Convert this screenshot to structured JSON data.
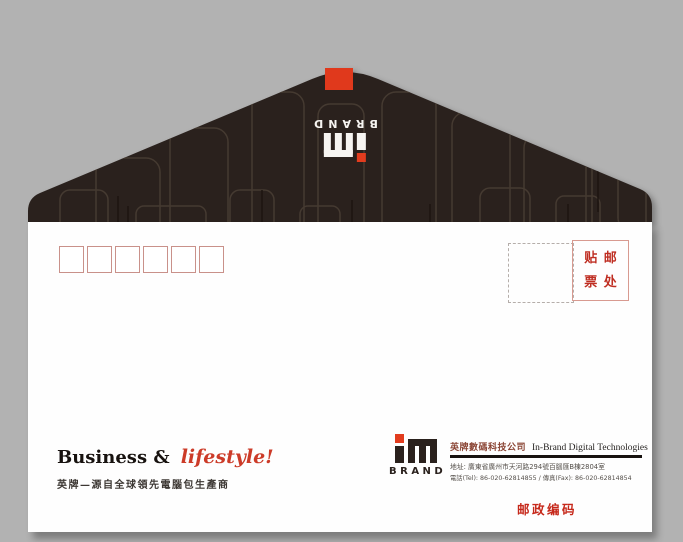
{
  "colors": {
    "background": "#b2b2b2",
    "flap": "#2a211d",
    "accent_red": "#e23c1e",
    "stamp_text_red": "#bf2e22",
    "postal_label_red": "#c6281a",
    "envelope": "#fefefe"
  },
  "logo": {
    "brand": "BRAND",
    "mark": "in-monogram"
  },
  "postal_code_boxes": {
    "count": 6
  },
  "stamp_area": {
    "top_left": "贴",
    "top_right": "邮",
    "bottom_left": "票",
    "bottom_right": "处"
  },
  "footer": {
    "tagline_en_black": "Business &",
    "tagline_en_red": "lifestyle!",
    "tagline_cn": "英牌—源自全球領先電腦包生產商",
    "postal_code_label": "邮政编码"
  },
  "company": {
    "name_cn": "英牌數碼科技公司",
    "name_en": "In-Brand Digital Technologies",
    "address": "地址: 廣東省廣州市天河路294號百腦匯B棟2804室",
    "phone_fax": "電話(Tel): 86-020-62814855 / 傳真(Fax): 86-020-62814854"
  }
}
